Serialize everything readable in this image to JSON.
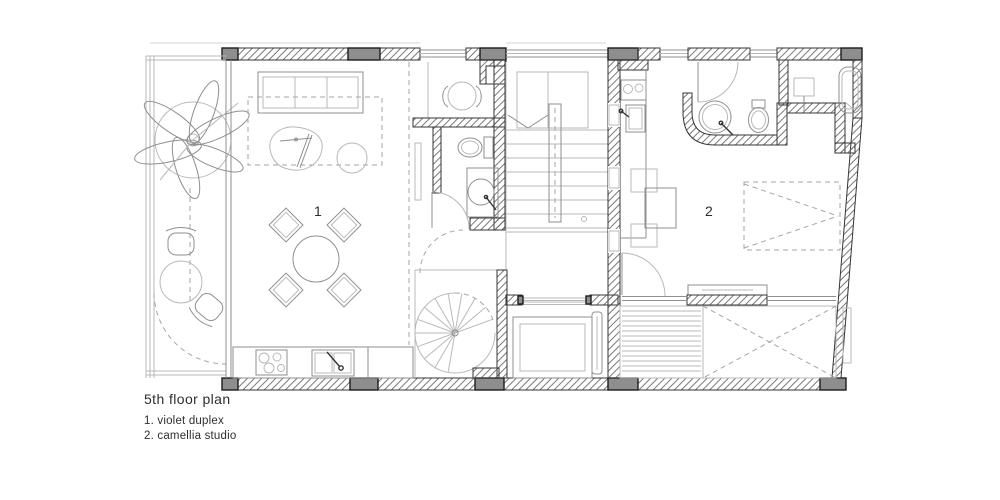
{
  "caption": {
    "title": "5th floor plan",
    "legend": [
      {
        "label": "1. violet duplex"
      },
      {
        "label": "2. camellia studio"
      }
    ]
  },
  "plan": {
    "rooms": [
      {
        "number": "1"
      },
      {
        "number": "2"
      }
    ]
  },
  "colors": {
    "paper": "#ffffff",
    "line_light": "#b9b9b9",
    "line_medium": "#8f8f8f",
    "wall_ink": "#353535",
    "column_fill": "#8e8e8e",
    "hatch_line": "#6a6a6a",
    "text_ink": "#2e2e2e"
  }
}
